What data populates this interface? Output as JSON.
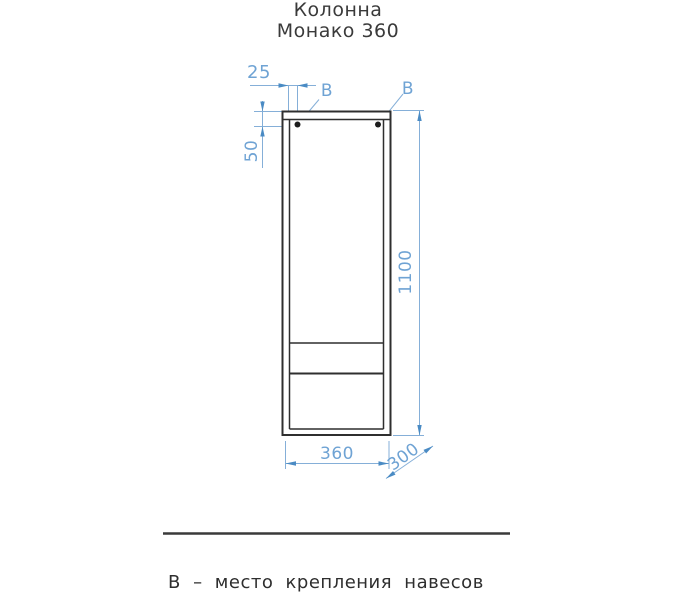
{
  "title": {
    "line1": "Колонна",
    "line2": "Монако 360"
  },
  "labels": {
    "b_left": "В",
    "b_right": "В"
  },
  "dimensions": {
    "hole_offset_horizontal": "25",
    "hole_offset_vertical": "50",
    "height": "1100",
    "width": "360",
    "depth": "300"
  },
  "note": "В – место крепления навесов",
  "colors": {
    "dimension_blue": "#6fa3d4",
    "dimension_arrow_blue": "#4a8bc4",
    "outline_dark": "#2f2f2f",
    "background": "#ffffff"
  }
}
